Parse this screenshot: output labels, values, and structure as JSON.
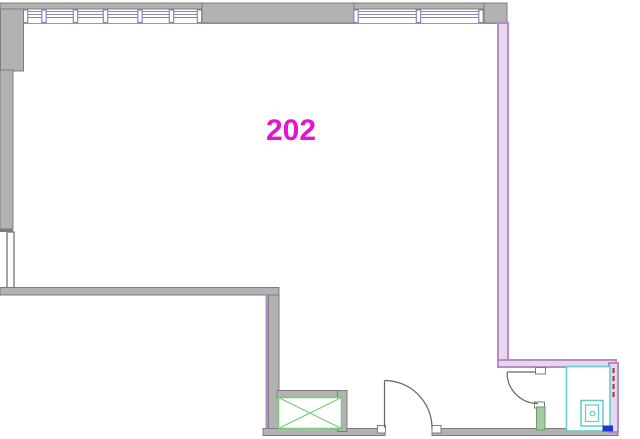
{
  "floorplan": {
    "room": {
      "number": "202"
    },
    "features": [
      "window-band-north-west",
      "window-band-north-east",
      "entry-door-south",
      "bathroom-door",
      "shaft-box",
      "shower-stall",
      "shower-pan-drain",
      "blue-threshold-fixture"
    ]
  },
  "colors": {
    "wall-fill": "#b2b2b2",
    "wall-edge": "#7d7d7d",
    "window-frame": "#8888b8",
    "label-magenta": "#e315d2",
    "wall-pink-fill": "#e7d7ee",
    "wall-pink-edge": "#b58cc8",
    "shaft-green": "#74ce74",
    "wall-green-fill": "#a5cba0",
    "wall-green-edge": "#6f9a6f",
    "shower-teal": "#62cccc",
    "fixture-blue": "#2334cc",
    "fire-dash-red": "#9e3434",
    "door-line": "#666666"
  }
}
